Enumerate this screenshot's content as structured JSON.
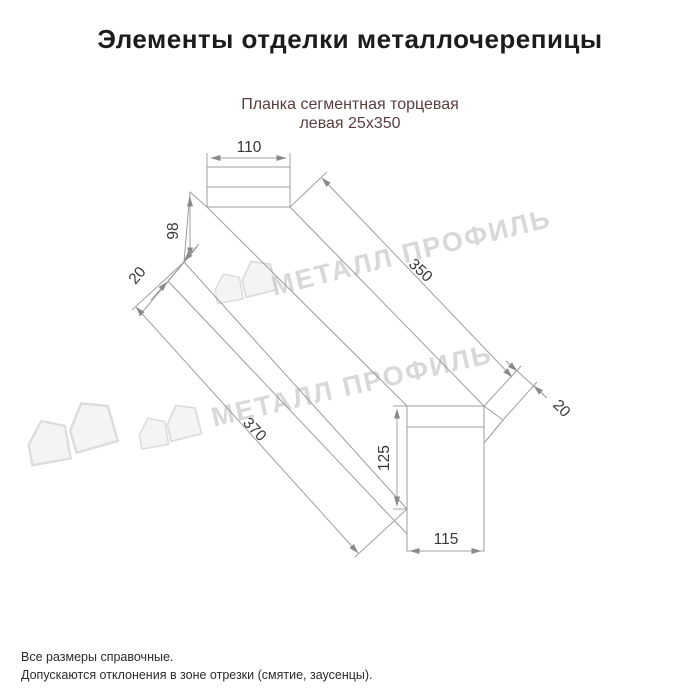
{
  "page": {
    "title": "Элементы отделки металлочерепицы",
    "product": {
      "line1": "Планка сегментная торцевая",
      "line2": "левая 25х350"
    },
    "footnotes": [
      "Все размеры справочные.",
      "Допускаются отклонения в зоне отрезки (смятие, заусенцы)."
    ]
  },
  "diagram": {
    "type": "technical-drawing",
    "dims": [
      {
        "id": "top-flange-width",
        "value": "110"
      },
      {
        "id": "left-end-height",
        "value": "98"
      },
      {
        "id": "left-hem",
        "value": "20"
      },
      {
        "id": "top-edge-length",
        "value": "350"
      },
      {
        "id": "bottom-edge-length",
        "value": "370"
      },
      {
        "id": "right-end-height",
        "value": "125"
      },
      {
        "id": "bottom-web-width",
        "value": "115"
      },
      {
        "id": "right-hem",
        "value": "20"
      }
    ]
  },
  "watermark": {
    "text": "МЕТАЛЛ ПРОФИЛЬ"
  },
  "colors": {
    "title": "#1c1c1c",
    "subtitle": "#5a3e3e",
    "drawing_line": "#9c9c9c",
    "dimension_text": "#383838",
    "watermark": "#b2b2b2",
    "background": "#ffffff"
  }
}
